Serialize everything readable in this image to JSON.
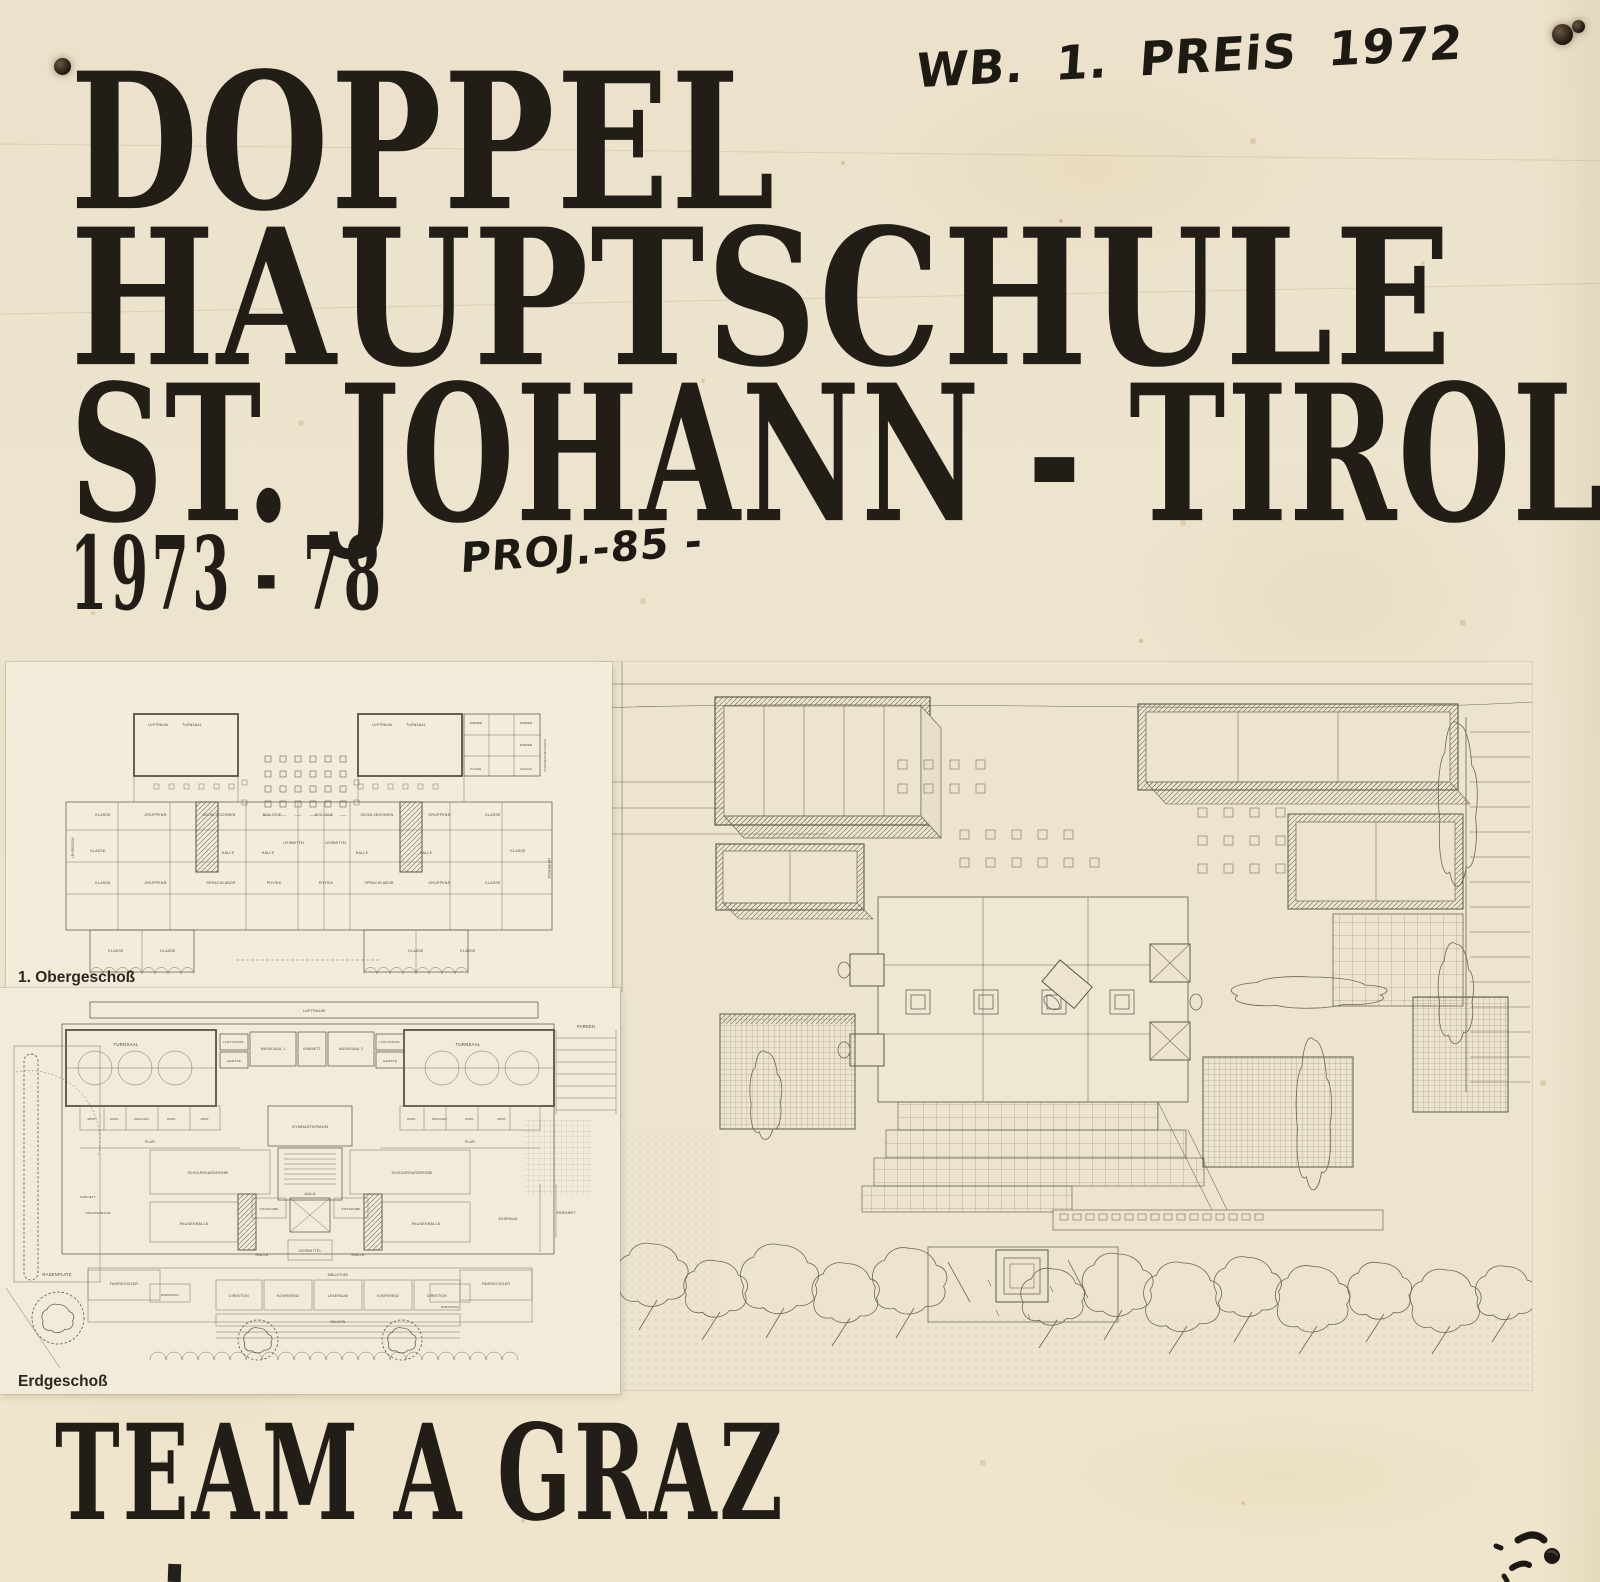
{
  "colors": {
    "paper": "#ede4cd",
    "sheet": "#f2ecdb",
    "ink": "#221e17",
    "plan_line": "#6a6253"
  },
  "header": {
    "award_note": "WB. 1. PREiS 1972"
  },
  "title": {
    "line1": "DOPPEL",
    "line2": "HAUPTSCHULE",
    "line3": "ST. JOHANN - TIROL",
    "years": "1973 - 78",
    "project_note": "PROJ.-85 -"
  },
  "footer": {
    "team": "TEAM A GRAZ"
  },
  "plans": {
    "upper": {
      "caption": "1. Obergeschoß",
      "labels": {
        "luftraum": "LUFTRAUM",
        "turnsaal": "TURNSAAL",
        "klasse": "KLASSE",
        "gruppenr": "GRUPPENR.",
        "geom": "GEOM.ZEICHNEN",
        "biologie": "BIOLOGIE",
        "sprachlabor": "SPRACHLABOR",
        "physik": "PHYSIK",
        "halle": "HALLE",
        "lehrmittel": "LEHRMITTEL",
        "lehrerzim": "LEHRERZIM.",
        "zimmer": "ZIMMER",
        "kueche": "KÜCHE",
        "loggia": "LOGGIA",
        "wohnung": "SCHULWARTWOHNUNG"
      }
    },
    "ground": {
      "caption": "Erdgeschoß",
      "labels": {
        "luftraum": "LUFTRAUM",
        "turnsaal": "TURNSAAL",
        "lueftungsz": "LÜFTUNGSZ.",
        "geraete": "GERÄTE",
        "musiksaal1": "MUSIKSAAL 1",
        "kabinett": "KABINETT",
        "musiksaal2": "MUSIKSAAL 2",
        "gymnastikraum": "GYMNASTIKRAUM",
        "umkl": "UMKL.",
        "waschr": "WASCHR.",
        "abst": "ABST.",
        "flur": "FLUR",
        "aula": "AULA",
        "garderobe": "SCHÜLERGARDEROBE",
        "pausenhalle": "PAUSENHALLE",
        "sitzgrube": "SITZGRUBE",
        "halle": "HALLE",
        "lehrmittel": "LEHRMITTEL",
        "bibliothek": "BIBLIOTHEK",
        "direktion": "DIREKTION",
        "konferenz": "KONFERENZ",
        "leseraum": "LESERAUM",
        "essraum": "ESSRAUM",
        "fahrschueler": "FAHRSCHÜLER",
        "windfang": "WINDFANG",
        "gruppenraum": "GRUPPENRAUM",
        "balkon": "BALKON",
        "rasenplatz": "RASENPLATZ",
        "parken": "PARKEN",
        "einfahrt": "EINFAHRT"
      }
    }
  }
}
